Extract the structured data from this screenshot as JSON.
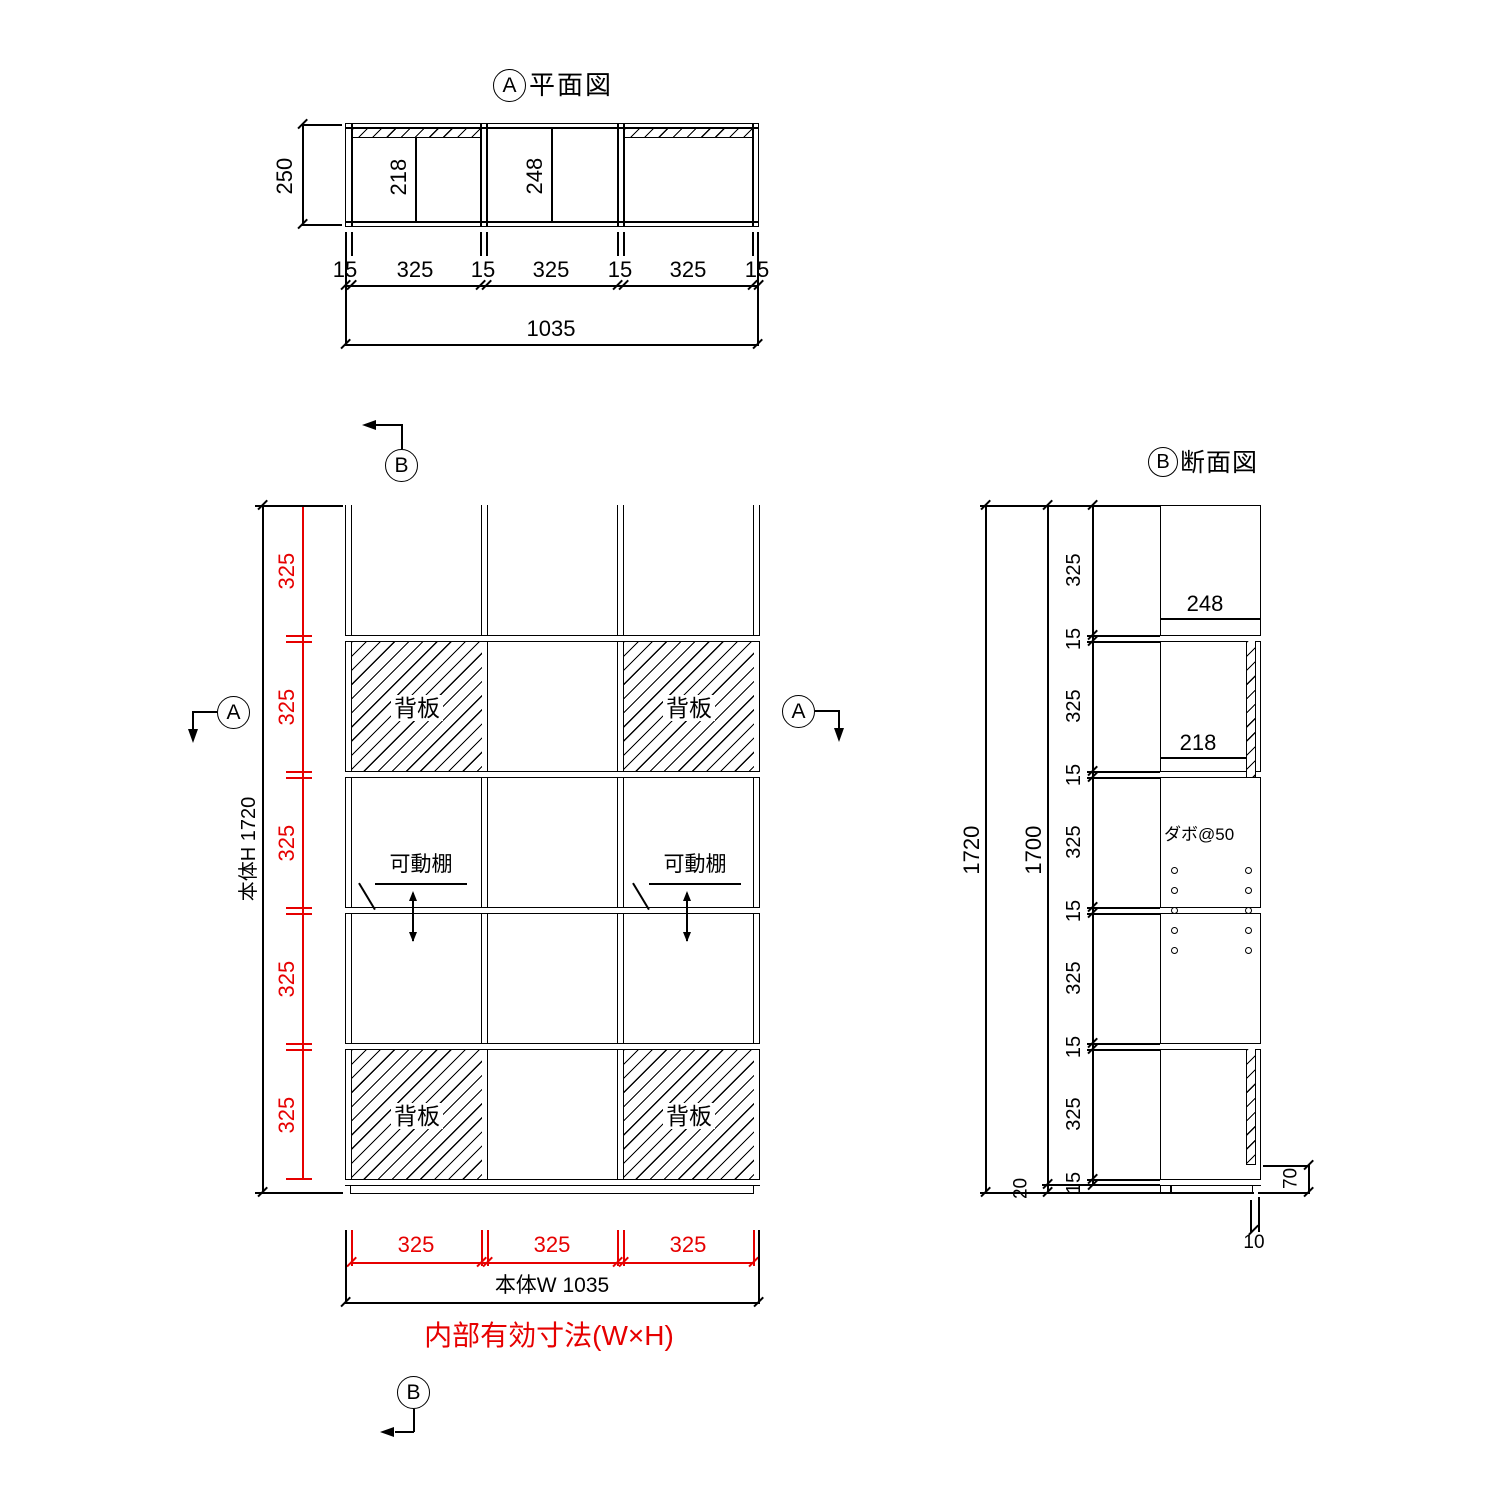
{
  "colors": {
    "line": "#000000",
    "accent": "#e60000",
    "background": "#ffffff"
  },
  "plan_view": {
    "marker": "A",
    "title": "平面図",
    "dims": {
      "depth": "250",
      "inner_depth_back": "218",
      "inner_depth_open": "248",
      "bottom_chain": [
        "15",
        "325",
        "15",
        "325",
        "15",
        "325",
        "15"
      ],
      "width_total": "1035"
    }
  },
  "front_view": {
    "markers": {
      "top": "B",
      "bottom": "B",
      "left": "A",
      "right": "A"
    },
    "labels": {
      "back_panel": "背板",
      "movable_shelf": "可動棚"
    },
    "dims": {
      "height_label": "本体H 1720",
      "rows": [
        "325",
        "325",
        "325",
        "325",
        "325"
      ],
      "cols": [
        "325",
        "325",
        "325"
      ],
      "width_label": "本体W 1035"
    },
    "caption": "内部有効寸法(W×H)"
  },
  "section_view": {
    "marker": "B",
    "title": "断面図",
    "labels": {
      "dowel_pitch": "ダボ@50"
    },
    "dims": {
      "height_total": "1720",
      "height_body": "1700",
      "base_height": "20",
      "chain": [
        "325",
        "15",
        "325",
        "15",
        "325",
        "15",
        "325",
        "15",
        "325",
        "15"
      ],
      "depth_open": "248",
      "depth_back": "218",
      "bottom_clearance": "70",
      "back_gap": "10"
    }
  }
}
